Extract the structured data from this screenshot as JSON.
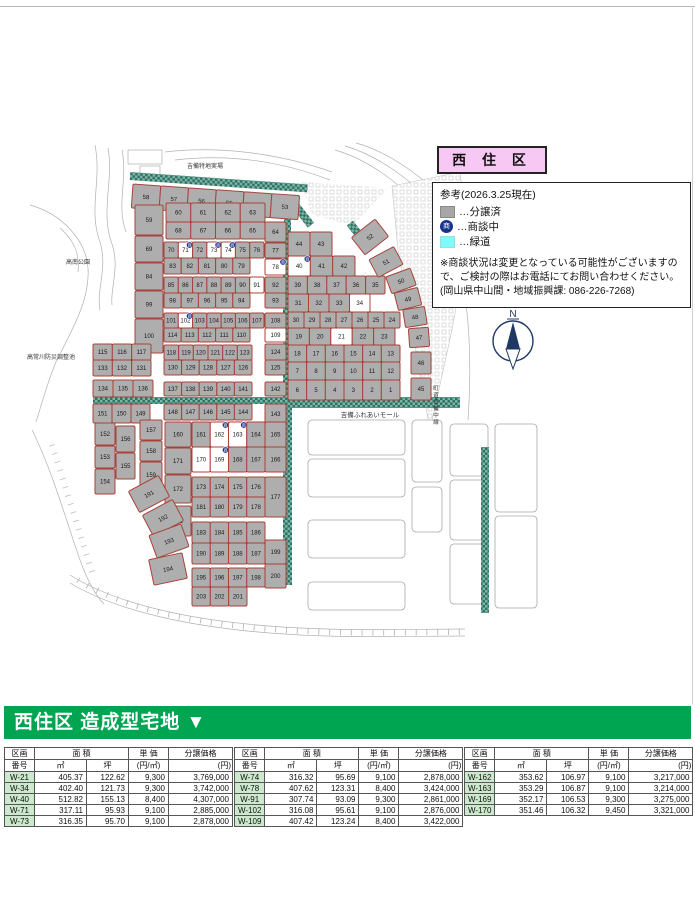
{
  "title_box": {
    "label": "西 住 区"
  },
  "legend": {
    "heading": "参考(2026.3.25現在)",
    "badge_glyph": "商",
    "items": [
      {
        "swatch": "sold",
        "label": "…分譲済"
      },
      {
        "swatch": "negotiating",
        "label": "…商談中"
      },
      {
        "swatch": "greenway",
        "label": "…緑道"
      }
    ],
    "note_lines": [
      "※商談状況は変更となっている可能性がございますの",
      "で、ご検討の際はお電話にてお問い合わせください。",
      "(岡山県中山間・地域振興課:  086-226-7268)"
    ]
  },
  "map": {
    "labels": {
      "top_area": "吉備特地実場",
      "park": "高南公園",
      "pond": "高常川防災調整池",
      "mall": "吉備ふれあいモール",
      "road_vertical": "町道吉備中線",
      "compass": "N"
    },
    "available_plots": [
      21,
      34,
      91,
      109,
      170
    ],
    "negotiating_plots": [
      40,
      71,
      73,
      74,
      78,
      102,
      162,
      163,
      169
    ],
    "blocks": [
      {
        "type": "row",
        "x": 133,
        "y": 184,
        "w": 167,
        "h": 24,
        "rot": 4,
        "plots": [
          58,
          57,
          56,
          55,
          54,
          53
        ]
      },
      {
        "type": "col",
        "x": 135,
        "w": 28,
        "cells": [
          [
            59,
            205,
            30
          ],
          [
            69,
            236,
            26
          ],
          [
            84,
            263,
            27
          ],
          [
            99,
            291,
            27
          ],
          [
            100,
            319,
            34
          ]
        ]
      },
      {
        "type": "row",
        "x": 166,
        "y": 203,
        "w": 99,
        "h": 19,
        "plots": [
          60,
          61,
          62,
          63
        ]
      },
      {
        "type": "row",
        "x": 166,
        "y": 222,
        "w": 99,
        "h": 17,
        "plots": [
          68,
          67,
          66,
          65
        ]
      },
      {
        "type": "row",
        "x": 164,
        "y": 242,
        "w": 100,
        "h": 16,
        "plots": [
          70,
          71,
          72,
          73,
          74,
          75,
          76
        ]
      },
      {
        "type": "row",
        "x": 164,
        "y": 258,
        "w": 86,
        "h": 16,
        "plots": [
          83,
          82,
          81,
          80,
          79
        ]
      },
      {
        "type": "row",
        "x": 164,
        "y": 277,
        "w": 100,
        "h": 16,
        "plots": [
          85,
          86,
          87,
          88,
          89,
          90,
          91
        ]
      },
      {
        "type": "row",
        "x": 164,
        "y": 293,
        "w": 86,
        "h": 15,
        "plots": [
          98,
          97,
          96,
          95,
          94
        ]
      },
      {
        "type": "row",
        "x": 164,
        "y": 313,
        "w": 100,
        "h": 15,
        "plots": [
          101,
          102,
          103,
          104,
          105,
          106,
          107
        ]
      },
      {
        "type": "row",
        "x": 164,
        "y": 328,
        "w": 86,
        "h": 14,
        "plots": [
          114,
          113,
          112,
          111,
          110
        ]
      },
      {
        "type": "row",
        "x": 164,
        "y": 345,
        "w": 88,
        "h": 15,
        "plots": [
          118,
          119,
          120,
          121,
          122,
          123
        ]
      },
      {
        "type": "row",
        "x": 164,
        "y": 360,
        "w": 88,
        "h": 15,
        "plots": [
          130,
          129,
          128,
          127,
          126
        ]
      },
      {
        "type": "row",
        "x": 164,
        "y": 382,
        "w": 88,
        "h": 14,
        "plots": [
          137,
          138,
          139,
          140,
          141
        ]
      },
      {
        "type": "row",
        "x": 164,
        "y": 404,
        "w": 88,
        "h": 16,
        "plots": [
          148,
          147,
          146,
          145,
          144
        ]
      },
      {
        "type": "col",
        "x": 265,
        "w": 21,
        "cells": [
          [
            64,
            222,
            20
          ],
          [
            77,
            243,
            15
          ],
          [
            78,
            259,
            16
          ],
          [
            92,
            277,
            16
          ],
          [
            93,
            293,
            15
          ],
          [
            108,
            313,
            15
          ],
          [
            109,
            328,
            14
          ],
          [
            124,
            344,
            16
          ],
          [
            125,
            360,
            15
          ],
          [
            142,
            382,
            14
          ],
          [
            143,
            404,
            20
          ]
        ]
      },
      {
        "type": "row",
        "x": 93,
        "y": 344,
        "w": 58,
        "h": 16,
        "plots": [
          115,
          116,
          117
        ]
      },
      {
        "type": "row",
        "x": 93,
        "y": 360,
        "w": 58,
        "h": 16,
        "plots": [
          133,
          132,
          131
        ]
      },
      {
        "type": "row",
        "x": 93,
        "y": 380,
        "w": 60,
        "h": 17,
        "plots": [
          134,
          135,
          136
        ]
      },
      {
        "type": "row",
        "x": 93,
        "y": 404,
        "w": 57,
        "h": 19,
        "plots": [
          151,
          150,
          149
        ]
      },
      {
        "type": "col",
        "x": 95,
        "w": 20,
        "cells": [
          [
            152,
            423,
            22
          ],
          [
            153,
            446,
            22
          ],
          [
            154,
            469,
            25
          ]
        ]
      },
      {
        "type": "col",
        "x": 116,
        "w": 19,
        "cells": [
          [
            156,
            426,
            26
          ],
          [
            155,
            453,
            26
          ]
        ]
      },
      {
        "type": "col",
        "x": 140,
        "w": 22,
        "cells": [
          [
            157,
            420,
            20
          ],
          [
            158,
            441,
            20
          ],
          [
            159,
            462,
            26
          ]
        ]
      },
      {
        "type": "col",
        "x": 165,
        "w": 26,
        "cells": [
          [
            160,
            422,
            25
          ],
          [
            171,
            448,
            26
          ],
          [
            172,
            475,
            28
          ],
          [
            182,
            506,
            30
          ]
        ]
      },
      {
        "type": "free",
        "cells": [
          [
            191,
            132,
            482,
            34,
            24,
            -28
          ],
          [
            192,
            146,
            506,
            34,
            24,
            -28
          ],
          [
            193,
            152,
            529,
            34,
            24,
            -20
          ],
          [
            194,
            151,
            556,
            34,
            26,
            -12
          ]
        ]
      },
      {
        "type": "row",
        "x": 192,
        "y": 422,
        "w": 73,
        "h": 25,
        "plots": [
          161,
          162,
          163,
          164
        ]
      },
      {
        "type": "row",
        "x": 192,
        "y": 447,
        "w": 73,
        "h": 25,
        "plots": [
          170,
          169,
          168,
          167
        ]
      },
      {
        "type": "row",
        "x": 192,
        "y": 477,
        "w": 73,
        "h": 20,
        "plots": [
          173,
          174,
          175,
          176
        ]
      },
      {
        "type": "row",
        "x": 192,
        "y": 497,
        "w": 73,
        "h": 20,
        "plots": [
          181,
          180,
          179,
          178
        ]
      },
      {
        "type": "row",
        "x": 192,
        "y": 522,
        "w": 73,
        "h": 21,
        "plots": [
          183,
          184,
          185,
          186
        ]
      },
      {
        "type": "row",
        "x": 192,
        "y": 543,
        "w": 73,
        "h": 21,
        "plots": [
          190,
          189,
          188,
          187
        ]
      },
      {
        "type": "row",
        "x": 192,
        "y": 568,
        "w": 73,
        "h": 19,
        "plots": [
          195,
          196,
          197,
          198
        ]
      },
      {
        "type": "row",
        "x": 192,
        "y": 587,
        "w": 55,
        "h": 19,
        "plots": [
          203,
          202,
          201
        ]
      },
      {
        "type": "col",
        "x": 265,
        "w": 21,
        "cells": [
          [
            165,
            422,
            25
          ],
          [
            166,
            447,
            25
          ],
          [
            177,
            477,
            40
          ],
          [
            199,
            540,
            24
          ],
          [
            200,
            564,
            24
          ]
        ]
      },
      {
        "type": "row",
        "x": 288,
        "y": 232,
        "w": 44,
        "h": 24,
        "plots": [
          44,
          43
        ]
      },
      {
        "type": "row",
        "x": 288,
        "y": 256,
        "w": 67,
        "h": 20,
        "plots": [
          40,
          41,
          42
        ]
      },
      {
        "type": "row",
        "x": 288,
        "y": 276,
        "w": 97,
        "h": 18,
        "plots": [
          39,
          38,
          37,
          36,
          35
        ]
      },
      {
        "type": "row",
        "x": 288,
        "y": 294,
        "w": 82,
        "h": 18,
        "plots": [
          31,
          32,
          33,
          34
        ]
      },
      {
        "type": "row",
        "x": 288,
        "y": 312,
        "w": 112,
        "h": 16,
        "plots": [
          30,
          29,
          28,
          27,
          26,
          25,
          24
        ]
      },
      {
        "type": "row",
        "x": 288,
        "y": 328,
        "w": 107,
        "h": 17,
        "plots": [
          19,
          20,
          21,
          22,
          23
        ]
      },
      {
        "type": "row",
        "x": 288,
        "y": 345,
        "w": 112,
        "h": 17,
        "plots": [
          18,
          17,
          16,
          15,
          14,
          13
        ]
      },
      {
        "type": "row",
        "x": 288,
        "y": 362,
        "w": 112,
        "h": 18,
        "plots": [
          7,
          8,
          9,
          10,
          11,
          12
        ]
      },
      {
        "type": "row",
        "x": 288,
        "y": 380,
        "w": 112,
        "h": 20,
        "plots": [
          6,
          5,
          4,
          3,
          2,
          1
        ]
      },
      {
        "type": "free",
        "cells": [
          [
            52,
            355,
            226,
            30,
            22,
            -38
          ],
          [
            51,
            372,
            252,
            28,
            20,
            -28
          ],
          [
            50,
            388,
            272,
            26,
            18,
            -20
          ],
          [
            49,
            396,
            290,
            24,
            18,
            -14
          ],
          [
            48,
            404,
            308,
            22,
            18,
            -9
          ],
          [
            47,
            409,
            328,
            20,
            19,
            -4
          ],
          [
            46,
            411,
            352,
            20,
            22,
            0
          ],
          [
            45,
            411,
            378,
            20,
            22,
            0
          ]
        ]
      }
    ]
  },
  "banner": {
    "label": "西住区 造成型宅地 ▼"
  },
  "tables": {
    "headers": {
      "id_top": "区画",
      "id_bottom": "番号",
      "area": "面 積",
      "m2": "㎡",
      "tsubo": "坪",
      "unit_top": "単 価",
      "unit_bottom": "(円/㎡)",
      "price_top": "分譲価格",
      "price_bottom": "(円)"
    },
    "groups": [
      {
        "rows": [
          [
            "W-21",
            "405.37",
            "122.62",
            "9,300",
            "3,769,000"
          ],
          [
            "W-34",
            "402.40",
            "121.73",
            "9,300",
            "3,742,000"
          ],
          [
            "W-40",
            "512.82",
            "155.13",
            "8,400",
            "4,307,000"
          ],
          [
            "W-71",
            "317.11",
            "95.93",
            "9,100",
            "2,885,000"
          ],
          [
            "W-73",
            "316.35",
            "95.70",
            "9,100",
            "2,878,000"
          ]
        ]
      },
      {
        "rows": [
          [
            "W-74",
            "316.32",
            "95.69",
            "9,100",
            "2,878,000"
          ],
          [
            "W-78",
            "407.62",
            "123.31",
            "8,400",
            "3,424,000"
          ],
          [
            "W-91",
            "307.74",
            "93.09",
            "9,300",
            "2,861,000"
          ],
          [
            "W-102",
            "316.08",
            "95.61",
            "9,100",
            "2,876,000"
          ],
          [
            "W-109",
            "407.42",
            "123.24",
            "8,400",
            "3,422,000"
          ]
        ]
      },
      {
        "rows": [
          [
            "W-162",
            "353.62",
            "106.97",
            "9,100",
            "3,217,000"
          ],
          [
            "W-163",
            "353.29",
            "106.87",
            "9,100",
            "3,214,000"
          ],
          [
            "W-169",
            "352.17",
            "106.53",
            "9,300",
            "3,275,000"
          ],
          [
            "W-170",
            "351.46",
            "106.32",
            "9,450",
            "3,321,000"
          ]
        ]
      }
    ]
  },
  "colors": {
    "banner_green": "#00a551",
    "title_pink": "#f8c8f4",
    "plot_gray": "#aeaeae",
    "plot_border": "#a8433b",
    "plot_available": "#ffffff",
    "greenway_dark": "#2e7466",
    "greenway_check": "#7fb3a6",
    "legend_cyan": "#7efcfc",
    "badge_navy": "#17338f",
    "table_green": "#cde9cd",
    "compass_navy": "#1f3864"
  }
}
